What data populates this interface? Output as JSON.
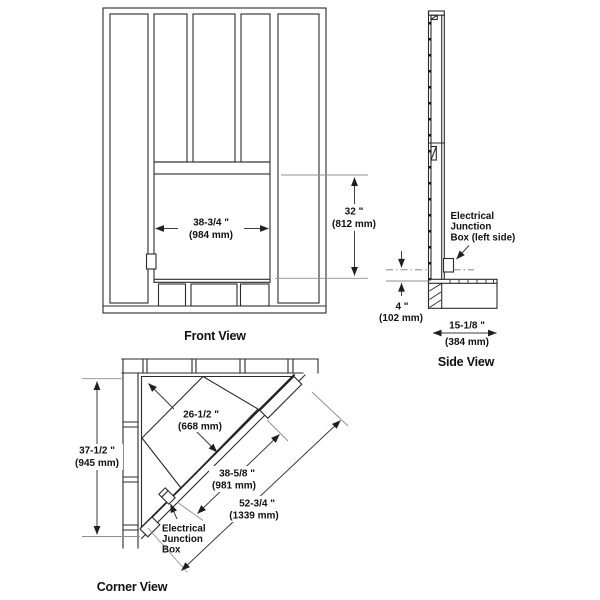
{
  "front_view": {
    "label": "Front View",
    "dim_width": {
      "imperial": "38-3/4 \"",
      "metric": "(984 mm)"
    },
    "dim_height": {
      "imperial": "32 \"",
      "metric": "(812 mm)"
    }
  },
  "side_view": {
    "label": "Side View",
    "junction_label": {
      "line1": "Electrical",
      "line2": "Junction",
      "line3": "Box (left side)"
    },
    "dim_junction_height": {
      "imperial": "4 \"",
      "metric": "(102 mm)"
    },
    "dim_base_depth": {
      "imperial": "15-1/8 \"",
      "metric": "(384 mm)"
    }
  },
  "corner_view": {
    "label": "Corner View",
    "junction_label": {
      "line1": "Electrical",
      "line2": "Junction",
      "line3": "Box"
    },
    "dim_wall_height": {
      "imperial": "37-1/2 \"",
      "metric": "(945 mm)"
    },
    "dim_corner_depth": {
      "imperial": "26-1/2 \"",
      "metric": "(668 mm)"
    },
    "dim_opening_width": {
      "imperial": "38-5/8 \"",
      "metric": "(981 mm)"
    },
    "dim_overall_width": {
      "imperial": "52-3/4 \"",
      "metric": "(1339 mm)"
    }
  },
  "colors": {
    "structure_line": "#2b2b2b",
    "dimension_line": "#3d3d3d",
    "extension_line": "#8f8f8f",
    "text": "#111111",
    "background": "#ffffff"
  }
}
